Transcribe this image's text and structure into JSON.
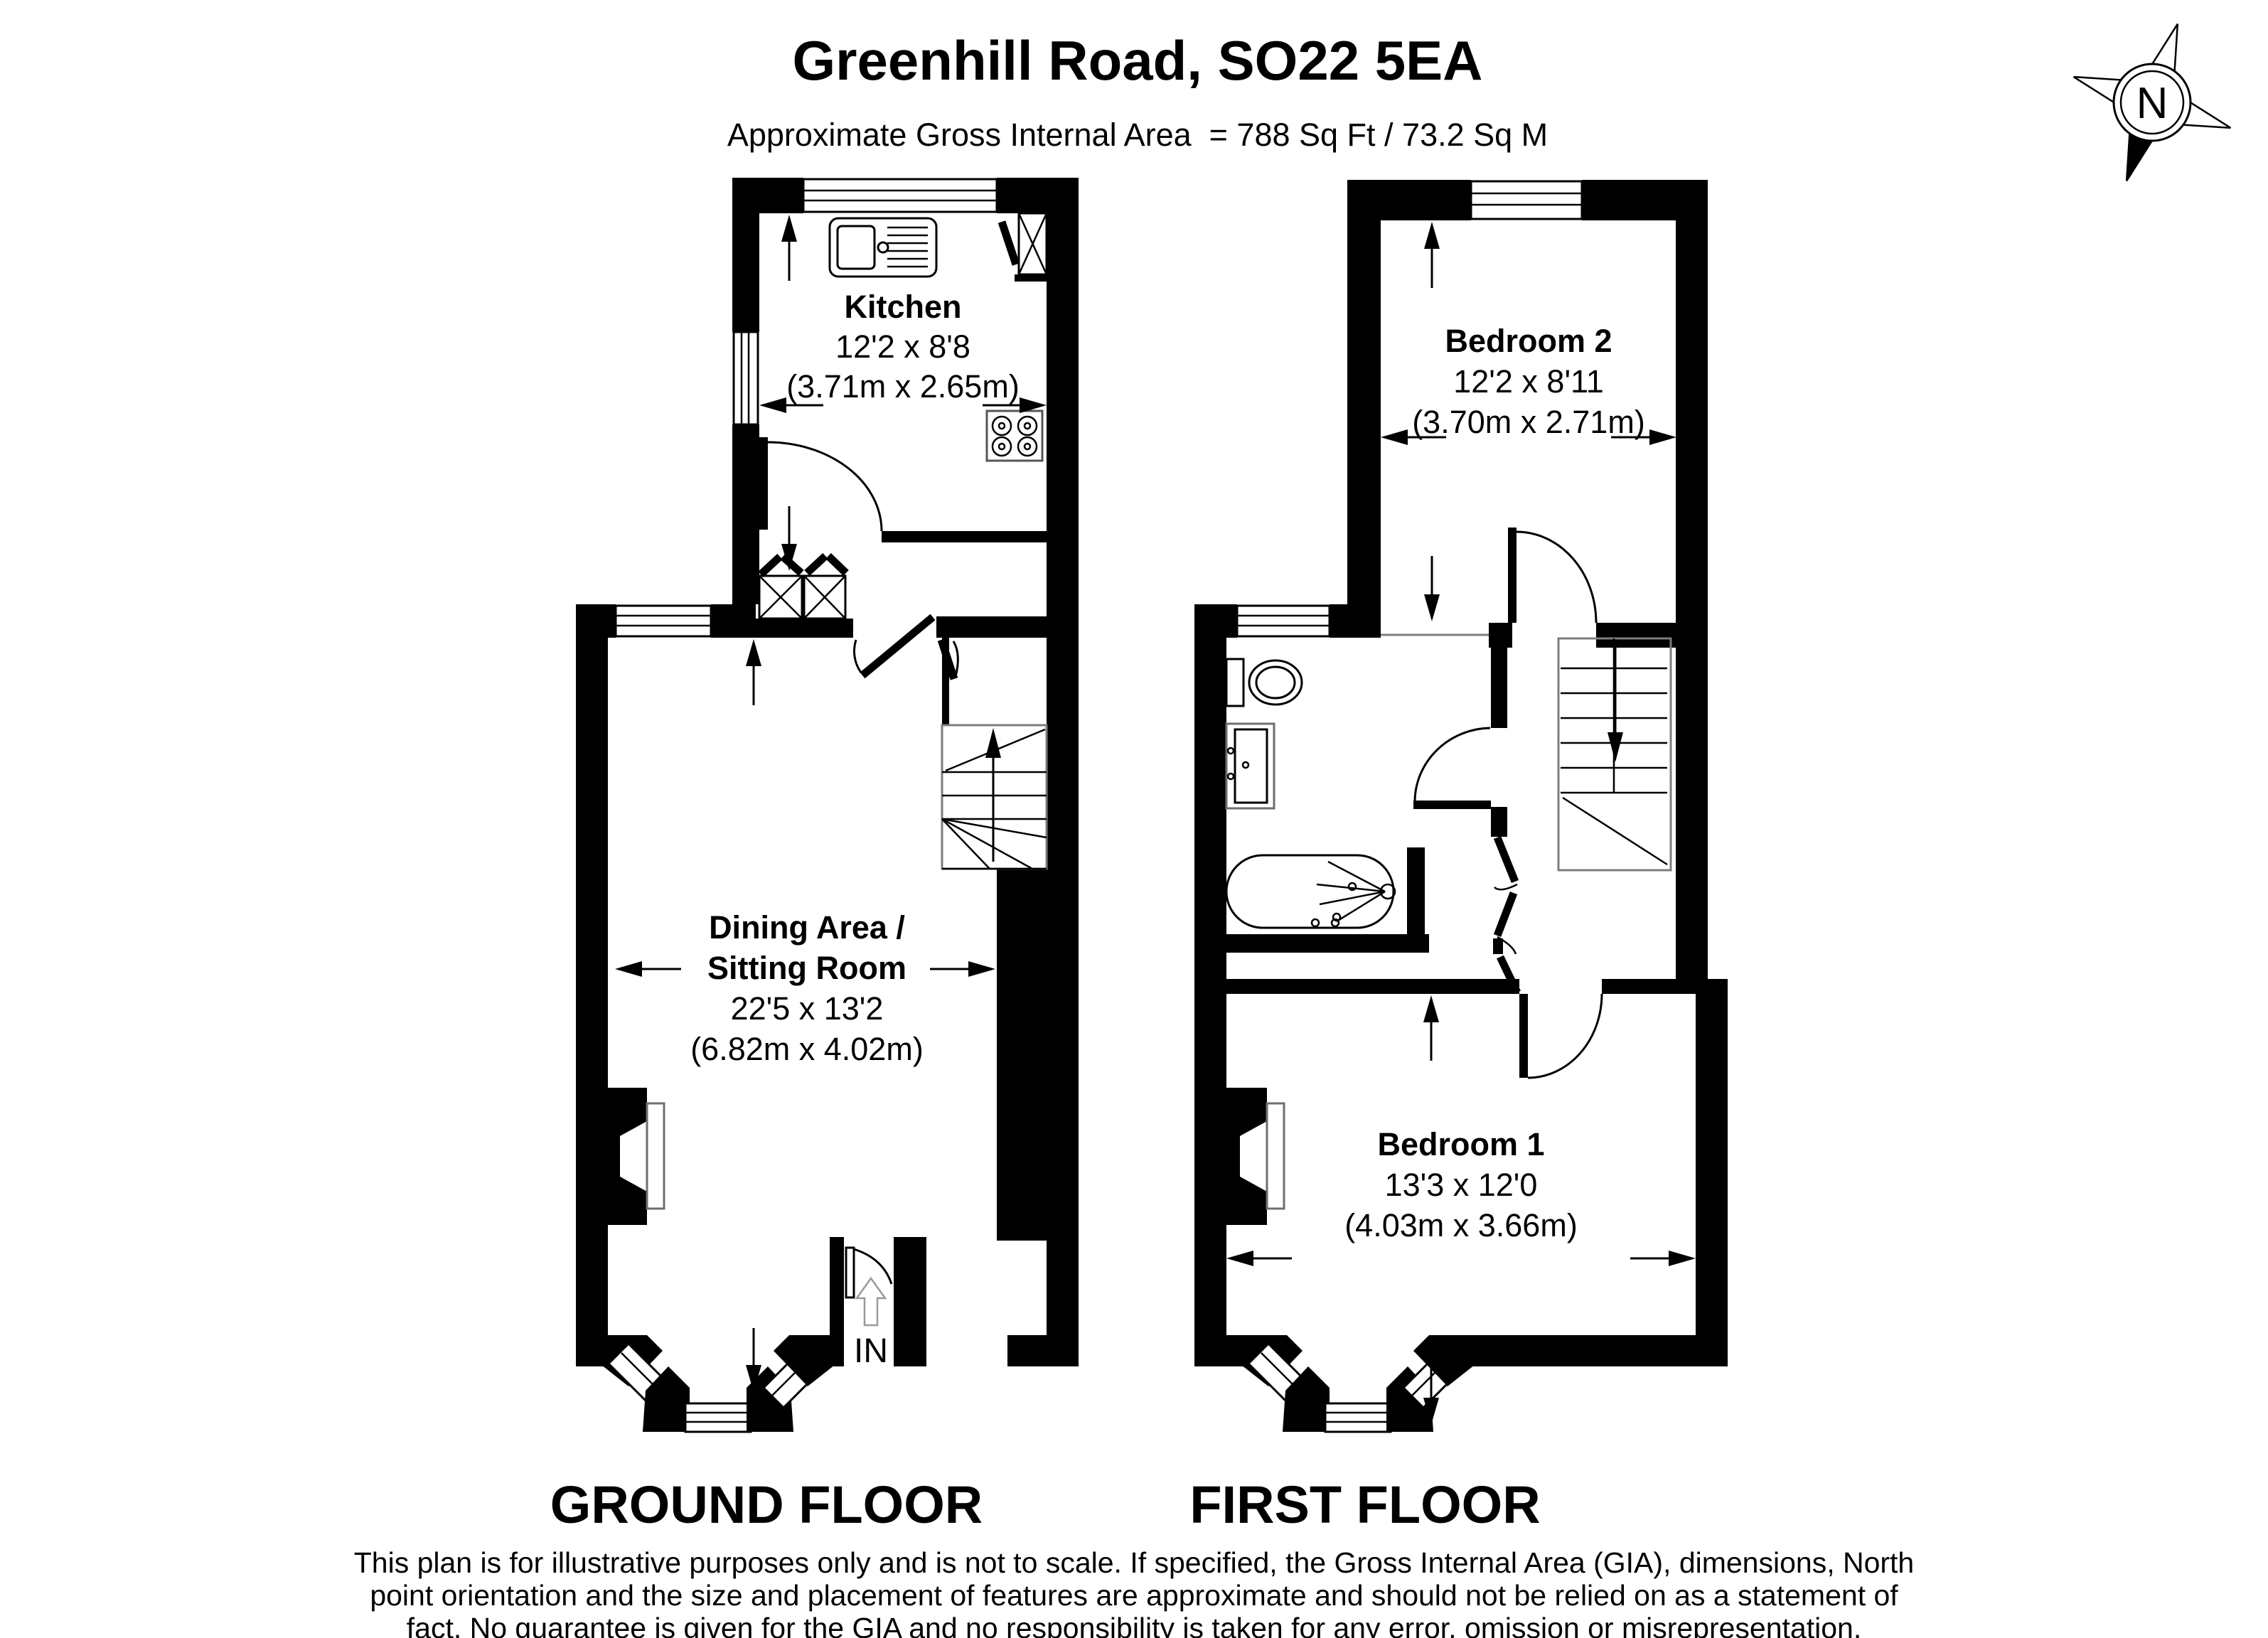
{
  "header": {
    "title": "Greenhill Road, SO22 5EA",
    "subtitle": "Approximate Gross Internal Area  = 788 Sq Ft / 73.2 Sq M"
  },
  "ground_floor": {
    "label": "GROUND FLOOR",
    "kitchen": {
      "name": "Kitchen",
      "size_imperial": "12'2 x 8'8",
      "size_metric": "(3.71m x 2.65m)"
    },
    "dining": {
      "name_line1": "Dining Area /",
      "name_line2": "Sitting Room",
      "size_imperial": "22'5 x 13'2",
      "size_metric": "(6.82m x 4.02m)"
    },
    "entrance_label": "IN"
  },
  "first_floor": {
    "label": "FIRST FLOOR",
    "bedroom2": {
      "name": "Bedroom 2",
      "size_imperial": "12'2 x 8'11",
      "size_metric": "(3.70m x 2.71m)"
    },
    "bedroom1": {
      "name": "Bedroom 1",
      "size_imperial": "13'3 x 12'0",
      "size_metric": "(4.03m x 3.66m)"
    }
  },
  "compass": {
    "label": "N"
  },
  "disclaimer": {
    "line1": "This plan is for illustrative purposes only and is not to scale. If specified, the Gross Internal Area (GIA), dimensions, North",
    "line2": "point orientation and the size and placement of features are approximate and should not be relied on as a statement of",
    "line3": "fact. No guarantee is given for the GIA and no responsibility is taken for any error, omission or misrepresentation."
  }
}
